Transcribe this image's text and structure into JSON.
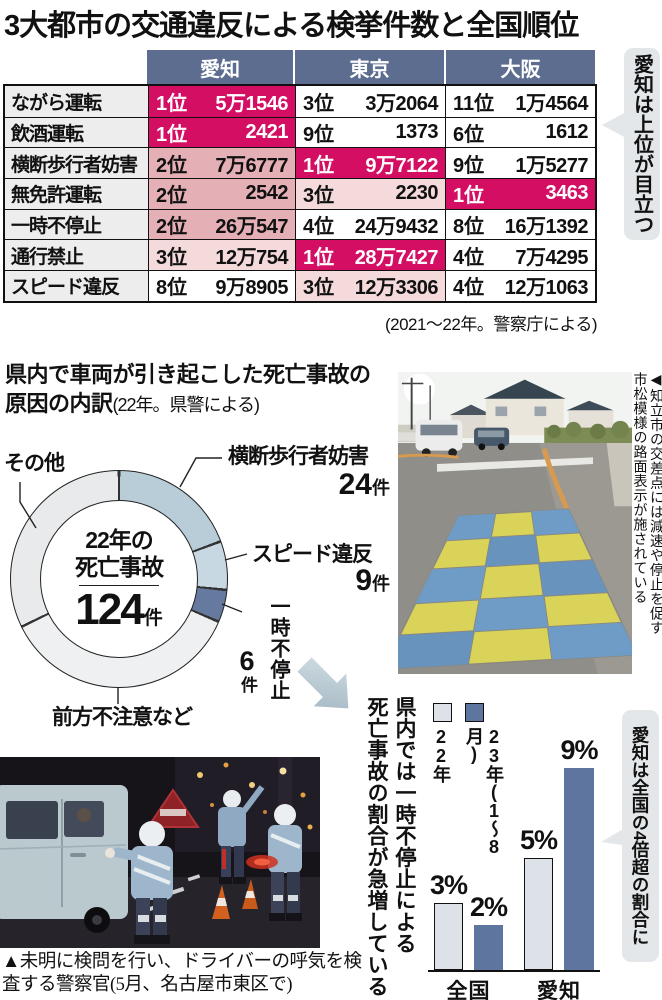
{
  "page": {
    "title": "3大都市の交通違反による検挙件数と全国順位"
  },
  "colors": {
    "rank1_magenta": "#d30e63",
    "rank2_salmon": "#e4afb5",
    "rank3_pink": "#f4dadb",
    "header_blue": "#5c6d90",
    "callout_gray": "#e4e7e9",
    "bar_2022": "#dce2e8",
    "bar_2023": "#5e75a0"
  },
  "table": {
    "columns": [
      "愛知",
      "東京",
      "大阪"
    ],
    "rows": [
      {
        "label": "ながら運転",
        "cells": [
          {
            "rank": "1位",
            "value": "5万1546",
            "tone": "first"
          },
          {
            "rank": "3位",
            "value": "3万2064",
            "tone": "none"
          },
          {
            "rank": "11位",
            "value": "1万4564",
            "tone": "none"
          }
        ]
      },
      {
        "label": "飲酒運転",
        "cells": [
          {
            "rank": "1位",
            "value": "2421",
            "tone": "first"
          },
          {
            "rank": "9位",
            "value": "1373",
            "tone": "none"
          },
          {
            "rank": "6位",
            "value": "1612",
            "tone": "none"
          }
        ]
      },
      {
        "label": "横断歩行者妨害",
        "cells": [
          {
            "rank": "2位",
            "value": "7万6777",
            "tone": "second"
          },
          {
            "rank": "1位",
            "value": "9万7122",
            "tone": "first"
          },
          {
            "rank": "9位",
            "value": "1万5277",
            "tone": "none"
          }
        ]
      },
      {
        "label": "無免許運転",
        "cells": [
          {
            "rank": "2位",
            "value": "2542",
            "tone": "second"
          },
          {
            "rank": "3位",
            "value": "2230",
            "tone": "third"
          },
          {
            "rank": "1位",
            "value": "3463",
            "tone": "first"
          }
        ]
      },
      {
        "label": "一時不停止",
        "cells": [
          {
            "rank": "2位",
            "value": "26万547",
            "tone": "second"
          },
          {
            "rank": "4位",
            "value": "24万9432",
            "tone": "none"
          },
          {
            "rank": "8位",
            "value": "16万1392",
            "tone": "none"
          }
        ]
      },
      {
        "label": "通行禁止",
        "cells": [
          {
            "rank": "3位",
            "value": "12万754",
            "tone": "third"
          },
          {
            "rank": "1位",
            "value": "28万7427",
            "tone": "first"
          },
          {
            "rank": "4位",
            "value": "7万4295",
            "tone": "none"
          }
        ]
      },
      {
        "label": "スピード違反",
        "cells": [
          {
            "rank": "8位",
            "value": "9万8905",
            "tone": "none"
          },
          {
            "rank": "3位",
            "value": "12万3306",
            "tone": "third"
          },
          {
            "rank": "4位",
            "value": "12万1063",
            "tone": "none"
          }
        ]
      }
    ],
    "source": "(2021〜22年。警察庁による)",
    "callout": "愛知は上位が目立つ"
  },
  "donut_section": {
    "title_line1": "県内で車両が引き起こした死亡事故の",
    "title_line2": "原因の内訳",
    "title_note": "(22年。県警による)"
  },
  "photos": {
    "road_caption_line1": "◀知立市の交差点には減速や停止を促す",
    "road_caption_line2": "市松模様の路面表示が施されている",
    "night_caption_line1": "▲未明に検問を行い、ドライバーの呼気を検",
    "night_caption_line2": "査する警察官(5月、名古屋市東区で)"
  },
  "bar_section": {
    "title_col1": "県内では一時不停止による",
    "title_col2": "死亡事故の割合が急増している"
  },
  "chart_data": [
    {
      "type": "pie",
      "subtype": "donut",
      "title": "県内で車両が引き起こした死亡事故の原因の内訳",
      "note": "22年。県警による",
      "total": 124,
      "center": {
        "line1": "22年の",
        "line2": "死亡事故",
        "value": "124",
        "unit": "件"
      },
      "segments": [
        {
          "label": "横断歩行者妨害",
          "value": 24,
          "display_num": "24",
          "display_unit": "件",
          "color": "#b9cdd8"
        },
        {
          "label": "スピード違反",
          "value": 9,
          "display_num": "9",
          "display_unit": "件",
          "color": "#c8d8e2"
        },
        {
          "label": "一時不停止",
          "value": 6,
          "display_num": "6",
          "display_unit": "件",
          "color": "#66799e"
        },
        {
          "label": "前方不注意など",
          "value": 45,
          "color": "#eff0f1"
        },
        {
          "label": "その他",
          "value": 40,
          "color": "#e8eaeb"
        }
      ]
    },
    {
      "type": "bar",
      "categories": [
        "全国",
        "愛知"
      ],
      "series": [
        {
          "name": "22年",
          "color": "#dce2e8",
          "values": [
            3,
            5
          ],
          "display": [
            "3%",
            "5%"
          ]
        },
        {
          "name": "23年(1〜8月)",
          "color": "#5e75a0",
          "values": [
            2,
            9
          ],
          "display": [
            "2%",
            "9%"
          ]
        }
      ],
      "unit": "%",
      "ylim": [
        0,
        9.5
      ],
      "legend_position": "top-left",
      "annotation": "愛知は全国の4倍超の割合に"
    }
  ]
}
